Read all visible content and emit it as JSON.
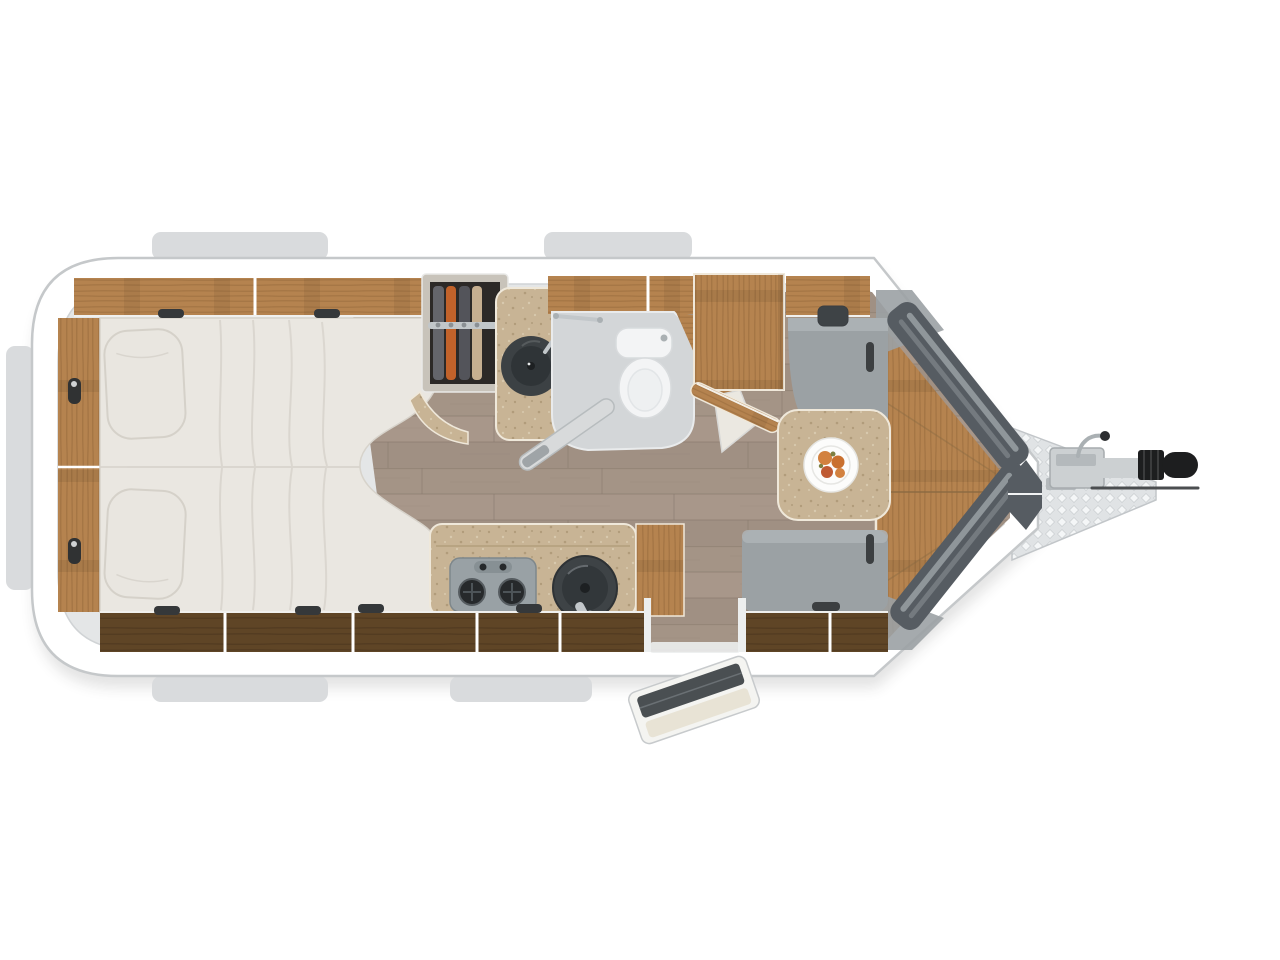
{
  "scene": {
    "type": "caravan-floor-plan-top-view",
    "rooms": [
      "bedroom",
      "wardrobe",
      "bathroom",
      "kitchen",
      "dinette"
    ],
    "furniture": [
      "island-bed",
      "pillows",
      "overhead-lockers",
      "wardrobe-with-clothes",
      "washbasin",
      "shower-tray",
      "toilet",
      "tall-cabinet",
      "sideboard",
      "dinette-seat-rear",
      "dinette-seat-front",
      "dinette-table",
      "fruit-plate",
      "kitchen-counter",
      "two-burner-stove",
      "round-sink",
      "nose-bench"
    ],
    "exterior": [
      "window-awnings",
      "panoramic-nose-windows",
      "a-frame-drawbar",
      "hitch-coupler",
      "jockey-wheel-crank",
      "entry-door-open",
      "entry-step"
    ]
  },
  "colors": {
    "background": "#ffffff",
    "shadow": "#1a1a1a",
    "window_tab": "#d9dbdd",
    "shell_fill": "#ffffff",
    "shell_stroke": "#c5c8ca",
    "interior_wall": "#e4e6e7",
    "interior_stroke": "#d0d3d5",
    "floor_base": "#a49486",
    "floor_light": "#b5a596",
    "floor_dark": "#8f8072",
    "floor_seam": "#887a6d",
    "wood_light": "#b5834f",
    "wood_streak": "#93683a",
    "wood_dark": "#5f4526",
    "wood_dark_streak": "#47321c",
    "wood_edge": "#f0e8da",
    "wood_seam": "#8a6a42",
    "bed_fill": "#eae7e1",
    "bed_stroke": "#d7d3cb",
    "bed_fold": "#d8d4cc",
    "pillow_fill": "#e9e6e0",
    "pillow_stroke": "#d5d1c9",
    "clip_dark": "#35383a",
    "handle_dark": "#303233",
    "wardrobe_frame": "#c8c3ba",
    "wardrobe_interior": "#2c2927",
    "cloth_gray": "#64656b",
    "cloth_gray2": "#53545a",
    "cloth_orange": "#c2622a",
    "cloth_beige": "#c6af90",
    "rail_chrome": "#c2c7ca",
    "counter_beige": "#c8b495",
    "speckle_dark": "#ab9674",
    "speckle_light": "#dccfb4",
    "counter_edge": "#efe8da",
    "basin_dark": "#3c4144",
    "basin_inner": "#2f3437",
    "bath_floor": "#d3d6d8",
    "bath_stroke": "#e9ebec",
    "toilet_fill": "#f3f4f5",
    "toilet_stroke": "#d8dbdd",
    "door_slab": "#d8dadb",
    "slab_stroke": "#b7bcbe",
    "door_handle": "#9fa4a7",
    "appliance_gray": "#99a1a5",
    "appliance_stroke": "#7e878b",
    "burner_dark": "#26292b",
    "sink_dark": "#3e4346",
    "sink_inner": "#32373a",
    "seat_gray": "#9ba1a4",
    "seat_light": "#aeb4b7",
    "seat_mark": "#3c3f41",
    "plate_white": "#fcfcfb",
    "plate_stroke": "#e6e6e3",
    "fruit_orange": "#d2813f",
    "fruit_orange2": "#c9702f",
    "fruit_red": "#bf5a33",
    "fruit_green": "#7d7f41",
    "nose_window": "#565c62",
    "nose_stripe": "#99a0a5",
    "drawbar_fill": "#e0e3e5",
    "drawbar_edge": "#c2c6c9",
    "checker_light": "#f4f6f7",
    "coupler_gray": "#ccd0d2",
    "coupler_mid": "#b4b9bc",
    "hitch_black": "#1d1e1f",
    "hitch_rib": "#3b3c3d",
    "metal_gray": "#aab0b3",
    "rod_dark": "#4b4e50",
    "entry_door_fill": "#f4f4f1",
    "entry_door_stroke": "#c7cacc",
    "entry_door_window": "#4a4f52",
    "entry_door_panel": "#e8e3d5",
    "jamb_white": "#eceeee",
    "wall_beige": "#ebe8e1"
  }
}
